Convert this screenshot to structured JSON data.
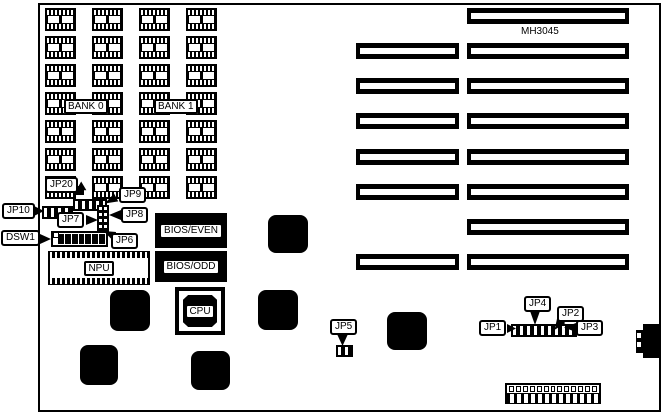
{
  "board": {
    "model": "MH3045",
    "ink": "#000000",
    "background": "#ffffff"
  },
  "labels": {
    "bank0": "BANK 0",
    "bank1": "BANK 1",
    "npu": "NPU",
    "cpu": "CPU",
    "bios_even": "BIOS/EVEN",
    "bios_odd": "BIOS/ODD"
  },
  "callouts": {
    "jp20": "JP20",
    "jp9": "JP9",
    "jp10": "JP10",
    "jp7": "JP7",
    "jp8": "JP8",
    "jp6": "JP6",
    "dsw1": "DSW1",
    "jp5": "JP5",
    "jp1": "JP1",
    "jp2": "JP2",
    "jp3": "JP3",
    "jp4": "JP4"
  },
  "structure": {
    "memory_grid": {
      "columns": 4,
      "rows": 7
    },
    "expansion_slots": {
      "count": 8,
      "left_segment_present": [
        false,
        true,
        true,
        true,
        true,
        true,
        false,
        true
      ]
    },
    "dip_switch": {
      "positions": 7
    },
    "power_connector": {
      "pins": 13
    }
  }
}
